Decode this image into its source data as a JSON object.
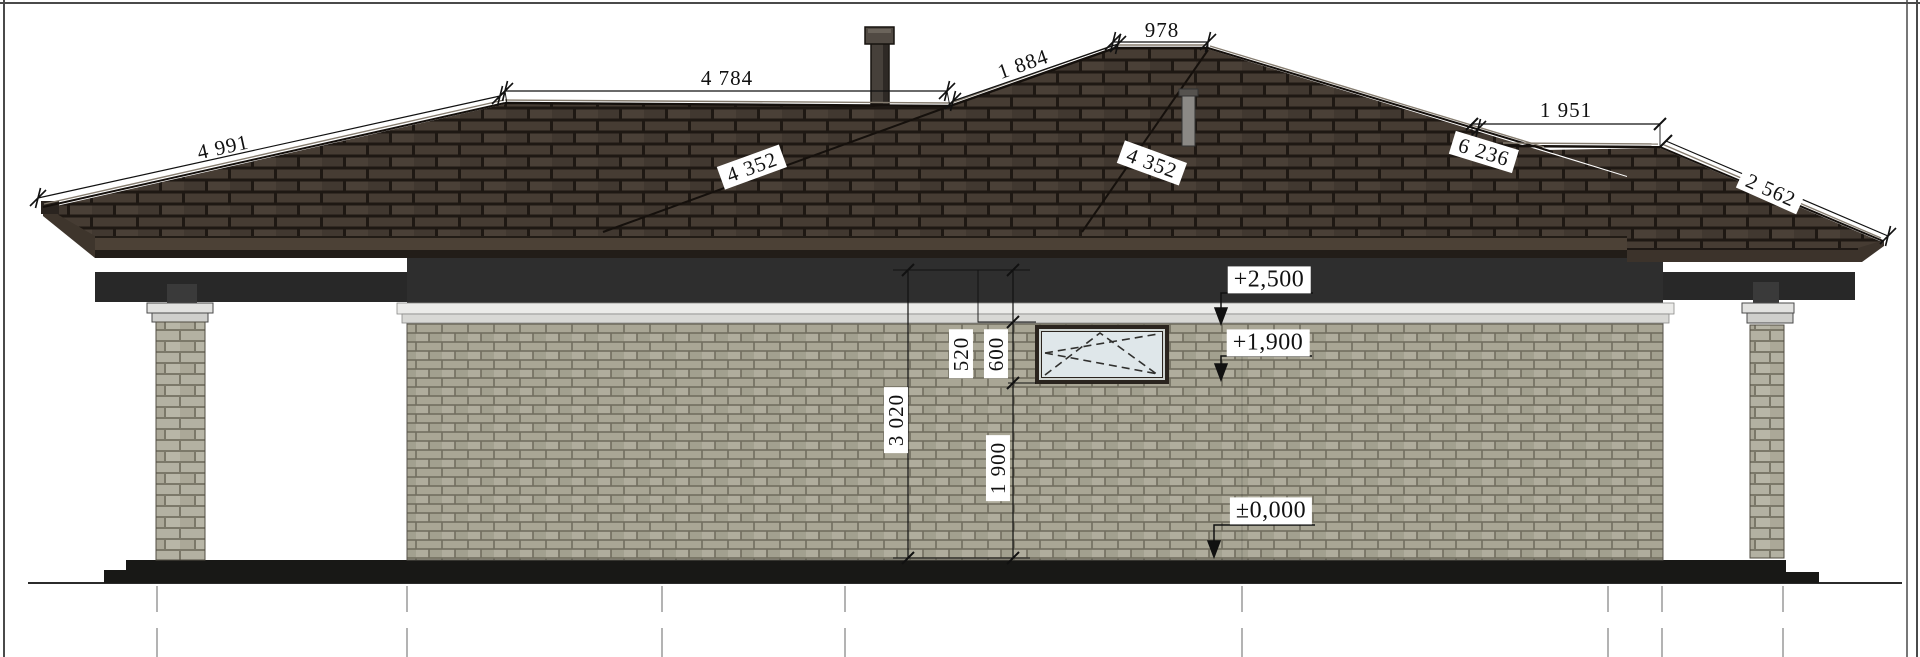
{
  "drawing": {
    "roof_dimensions": {
      "left_hip_slope": "4 991",
      "left_ridge": "4 784",
      "middle_hip_slope": "1 884",
      "middle_ridge": "978",
      "left_valley": "4 352",
      "right_valley": "4 352",
      "right_main_slope": "6 236",
      "right_ridge": "1 951",
      "right_hip_slope": "2 562"
    },
    "vertical_dimensions": {
      "wall_height": "3 020",
      "eave_to_window_top": "520",
      "window_height": "600",
      "window_sill_to_ground": "1 900"
    },
    "elevation_levels": {
      "eave_level": "+2,500",
      "window_head_level": "+1,900",
      "ground_level": "±0,000"
    },
    "colors": {
      "roof_shingle": "#463c33",
      "roof_shadow": "#1e1813",
      "wall_brick": "#a9a695",
      "mortar": "#716e5f",
      "plinth": "#181816",
      "cornice_trim": "#ebebe9",
      "soffit": "#2e2e2e",
      "window_glass": "#dfe7ea",
      "dimension_ink": "#111111"
    }
  }
}
